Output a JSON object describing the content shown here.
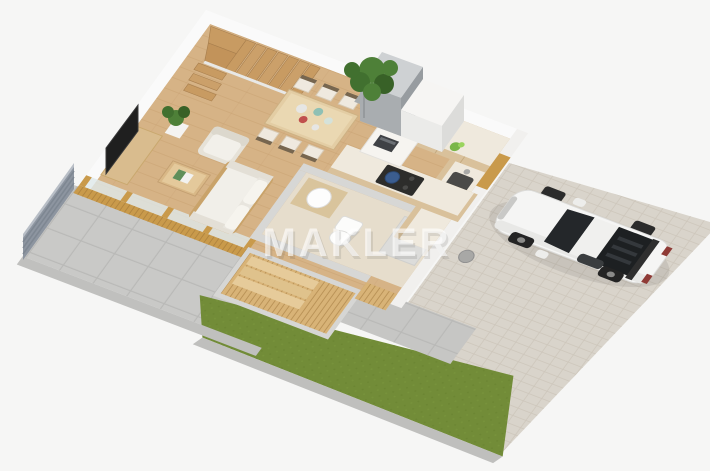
{
  "watermark": {
    "text": "MAKLER"
  },
  "scene": {
    "title": "isometric-ground-floor-plan-render",
    "rooms": [
      "living-room",
      "dining-area",
      "kitchen",
      "bathroom",
      "entry-vestibule",
      "staircase"
    ],
    "exterior": [
      "patio-terrace",
      "privacy-fence",
      "lawn-strip",
      "paver-driveway",
      "white-sports-car",
      "walkway"
    ]
  },
  "palette": {
    "background": "#f6f6f5",
    "wall": "#fafafa",
    "wall_side": "#f1f0ee",
    "wood_floor": "#d6b386",
    "wood_slat": "#d8b377",
    "gold_frame": "#c99a4b",
    "counter_wood": "#d9c19b",
    "counter_top": "#efe9dd",
    "patio_tile": "#c9c9c7",
    "paver": "#d9d4cb",
    "grass": "#728c38",
    "edging": "#c0c0be",
    "fence": "#8d95a0",
    "bath_wall": "#d7d7d5",
    "car_body": "#f5f5f4",
    "glass": "#dfe8ea",
    "watermark_fill": "rgba(255,255,255,0.62)"
  }
}
